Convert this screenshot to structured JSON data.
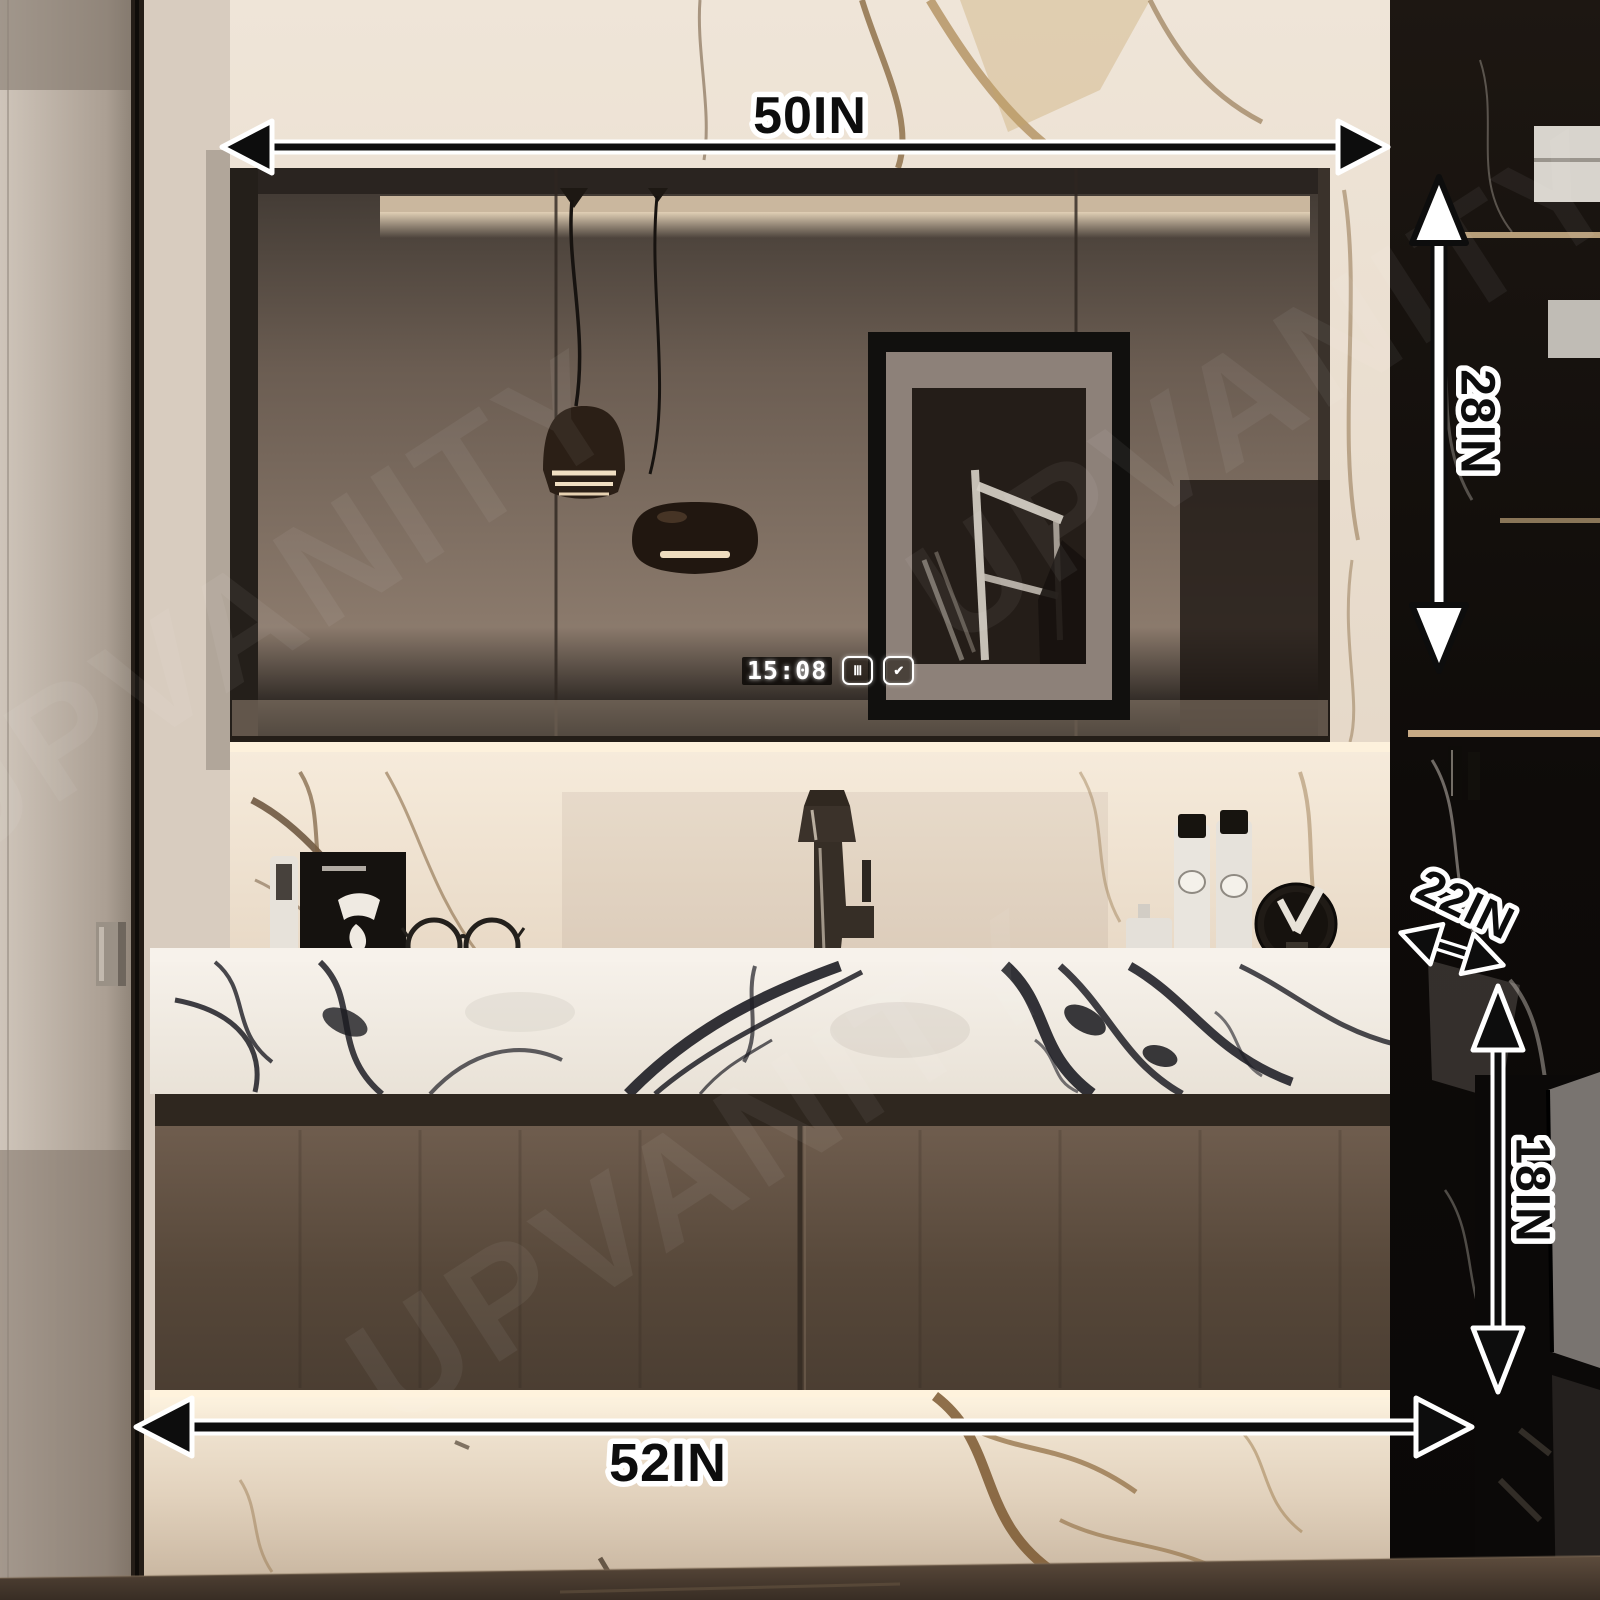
{
  "image": {
    "type": "product-dimension-photo",
    "subject": "Wall-mounted bathroom vanity with LED mirror cabinet, marble countertop and floating brown drawer cabinet",
    "watermark": "UPVANITY"
  },
  "annotations": {
    "top_width": "50IN",
    "mirror_height": "28IN",
    "depth": "22IN",
    "cabinet_height": "18IN",
    "bottom_width": "52IN"
  },
  "mirror_display": {
    "time": "15:08",
    "defog_icon_glyph": "Ⅲ",
    "check_icon_glyph": "✔"
  },
  "colors": {
    "annotation_fill": "#0d0d0d",
    "annotation_outline": "#ffffff",
    "warm_glow": "#f7ecd9",
    "cabinet_brown": "#5e4e41",
    "counter_vein": "#1d1d24",
    "right_wall_black": "#120f0c"
  }
}
